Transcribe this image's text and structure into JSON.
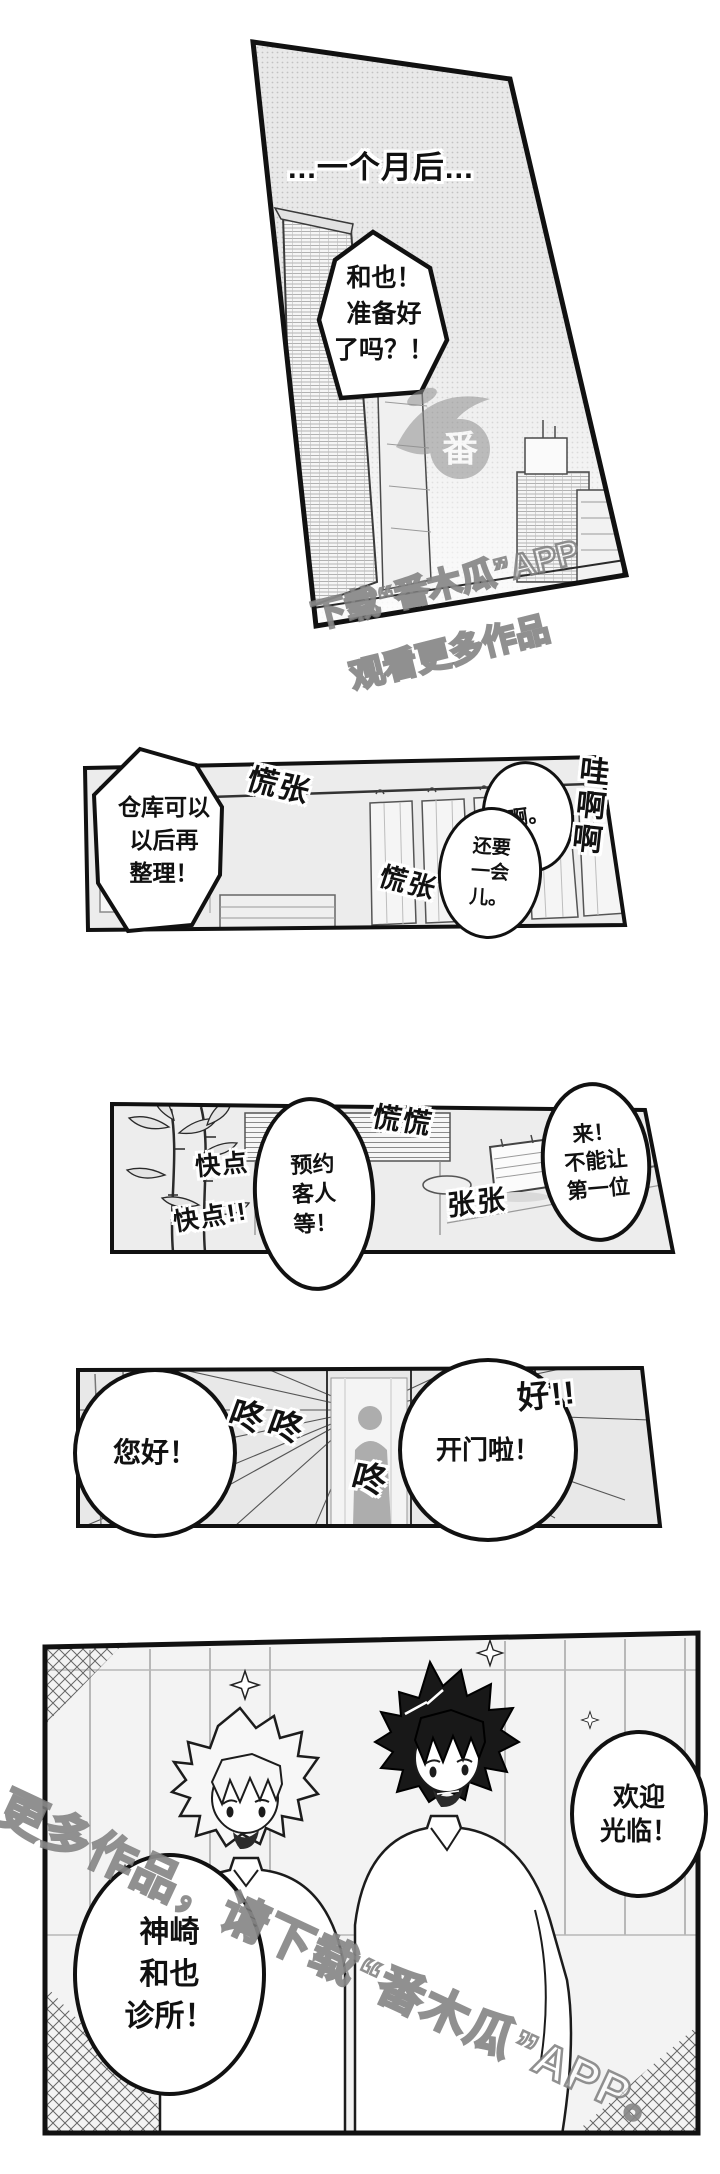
{
  "colors": {
    "ink": "#111111",
    "panel_bg": "#ededed",
    "watermark": "#8f8f8f"
  },
  "panel1": {
    "caption": "...一个月后...",
    "bubble_ready": [
      "和也！",
      "准备好",
      "了吗？！"
    ]
  },
  "watermark_top": {
    "logo_char": "番",
    "line1": "下载“番木瓜”APP",
    "line2": "观看更多作品"
  },
  "panel2": {
    "bubble_warehouse": [
      "仓库可以",
      "以后再",
      "整理！"
    ],
    "sfx_fluster_top": "慌张",
    "sfx_fluster_bottom": "慌张",
    "bubble_ah": "啊。",
    "bubble_wait": [
      "还要",
      "一会",
      "儿。"
    ],
    "sfx_wail": "哇啊啊"
  },
  "panel3": {
    "sfx_hurry_top": "快点",
    "sfx_hurry_bottom": "快点!!",
    "bubble_appointment": [
      "预约",
      "客人",
      "等！"
    ],
    "sfx_fluster": "慌慌",
    "sfx_rush": "张张",
    "bubble_first_customer": [
      "来！",
      "不能让",
      "第一位"
    ]
  },
  "panel4": {
    "bubble_hello": "您好！",
    "sfx_knock_double": "咚咚",
    "sfx_knock_single": "咚",
    "bubble_open_door": "开门啦！",
    "sfx_ok": "好!!"
  },
  "panel5": {
    "bubble_welcome": [
      "欢迎",
      "光临！"
    ],
    "bubble_clinic_name": [
      "神崎",
      "和也",
      "诊所！"
    ]
  },
  "watermark_bottom": {
    "text": "更多作品，请下载“番木瓜”APP。"
  }
}
